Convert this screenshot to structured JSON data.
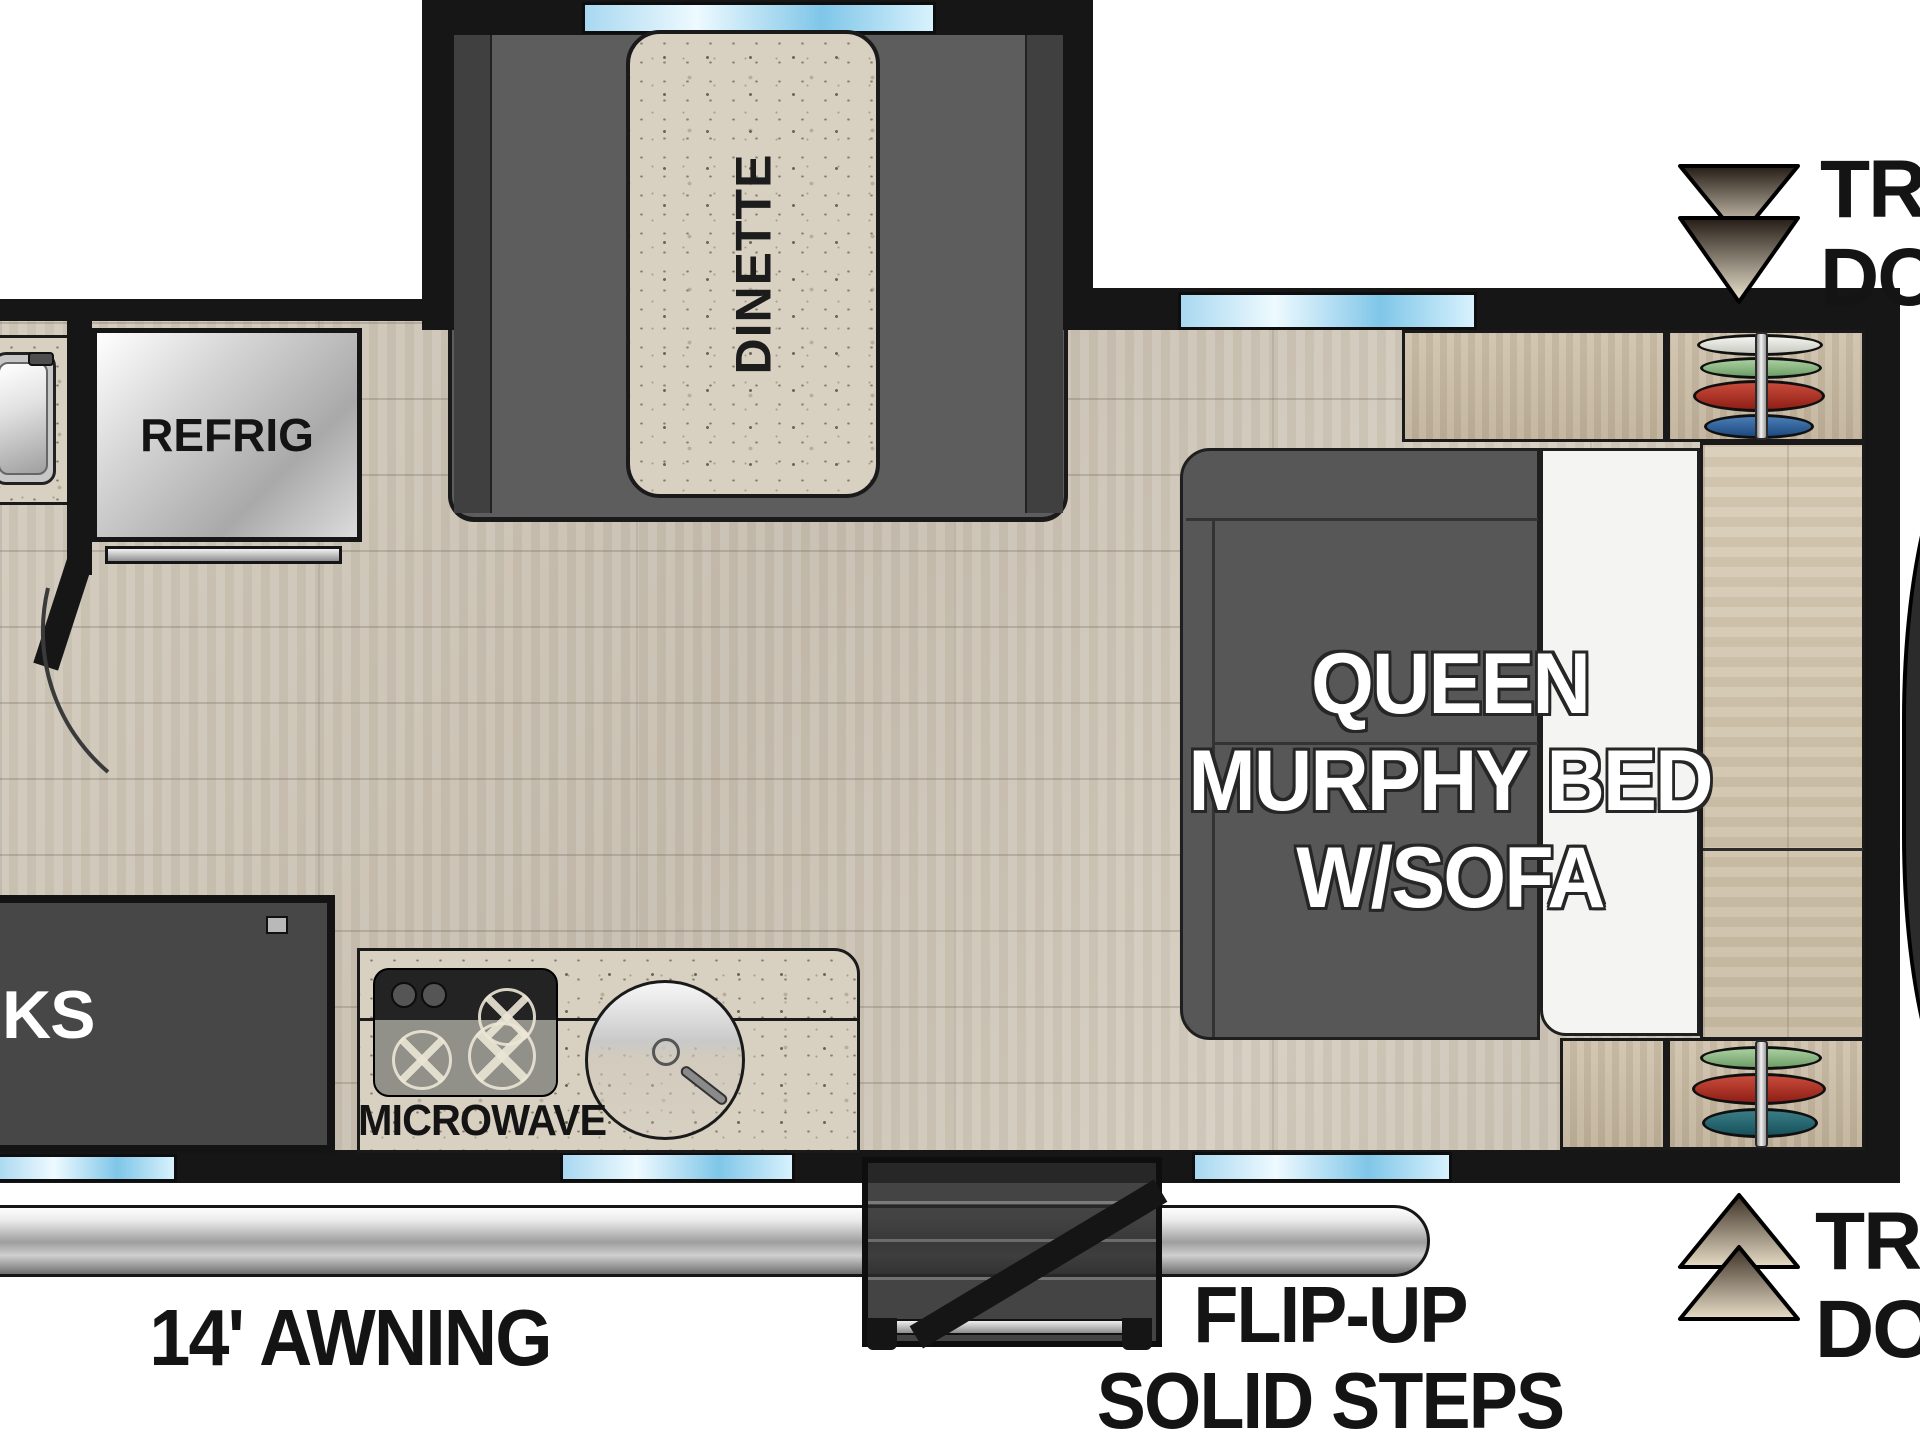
{
  "title": "Travel trailer floor plan",
  "colors": {
    "wall": "#161616",
    "floor_wood": "#cdc5b6",
    "cabinet_wood": "#c9bca6",
    "slideout_gray": "#5d5d5d",
    "sofa_gray": "#575757",
    "granite": "#d8d1c2",
    "window_blue": "#9fd4ef",
    "awning_silver": "#c0c0c0",
    "marker_dark": "#2a2118",
    "marker_light": "#ece2cc"
  },
  "dinette": {
    "table_label": "DINETTE"
  },
  "kitchen": {
    "refrig_label": "REFRIG",
    "microwave_label": "MICROWAVE"
  },
  "murphy_bed": {
    "line1": "QUEEN",
    "line2": "MURPHY BED",
    "line3": "W/SOFA"
  },
  "bunks": {
    "visible_label": "KS"
  },
  "exterior": {
    "awning_label": "14' AWNING",
    "steps_label_line1": "FLIP-UP",
    "steps_label_line2": "SOLID STEPS",
    "front_cap_label": "ESCAPE"
  },
  "door_markers": {
    "top": {
      "line1": "TR",
      "line2": "DO"
    },
    "bottom": {
      "line1": "TR",
      "line2": "DO"
    }
  },
  "wardrobe_top": {
    "items": [
      "white",
      "green",
      "red",
      "blue"
    ]
  },
  "wardrobe_bottom": {
    "items": [
      "green",
      "red",
      "teal"
    ]
  }
}
